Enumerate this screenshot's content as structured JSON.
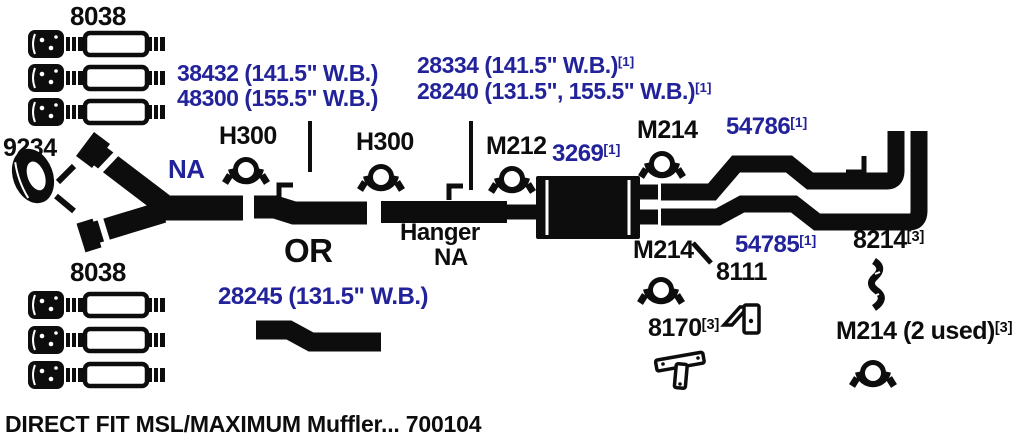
{
  "colors": {
    "navy": "#22229a",
    "ink": "#0d0d0d",
    "background": "#ffffff"
  },
  "caption": "DIRECT FIT MSL/MAXIMUM Muffler... 700104",
  "labels": {
    "converter_top": "8038",
    "converter_bottom": "8038",
    "gasket": "9234",
    "pipe_38432": "38432 (141.5\" W.B.)",
    "pipe_48300": "48300 (155.5\" W.B.)",
    "pipe_28334": {
      "text": "28334 (141.5\" W.B.)",
      "sup": "[1]"
    },
    "pipe_28240": {
      "text": "28240 (131.5\", 155.5\" W.B.)",
      "sup": "[1]"
    },
    "hanger_front": "H300",
    "hanger_mid": "H300",
    "na_pipe": "NA",
    "clamp_front": "M212",
    "muffler": {
      "text": "3269",
      "sup": "[1]"
    },
    "clamp_outlet_top": "M214",
    "clamp_outlet_bottom": "M214",
    "tailpipe_top": {
      "text": "54786",
      "sup": "[1]"
    },
    "tailpipe_bottom": {
      "text": "54785",
      "sup": "[1]"
    },
    "or": "OR",
    "hanger_word": "Hanger",
    "hanger_na": "NA",
    "pipe_28245": "28245 (131.5\" W.B.)",
    "bracket_8111": "8111",
    "strap_8214": {
      "text": "8214",
      "sup": "[3]"
    },
    "bracket_8170": {
      "text": "8170",
      "sup": "[3]"
    },
    "clamp_2used": {
      "text": "M214 (2 used)",
      "sup": "[3]"
    }
  },
  "icons": {
    "gasket-icon": "oval exhaust flange gasket ring",
    "converter-icon": "catalytic converter with corrugated connectors",
    "clamp-icon": "round U-bolt exhaust clamp",
    "hanger-icon": "round exhaust hanger clamp",
    "muffler-icon": "black oval muffler body",
    "corner-bracket-icon": "angled hanger bracket with hole",
    "strap-bracket-icon": "wavy strap hanger bracket",
    "t-bracket-icon": "tee shaped hanger bracket",
    "pipe-icon": "black exhaust pipe runs with S-bends and twin vertical tips"
  }
}
